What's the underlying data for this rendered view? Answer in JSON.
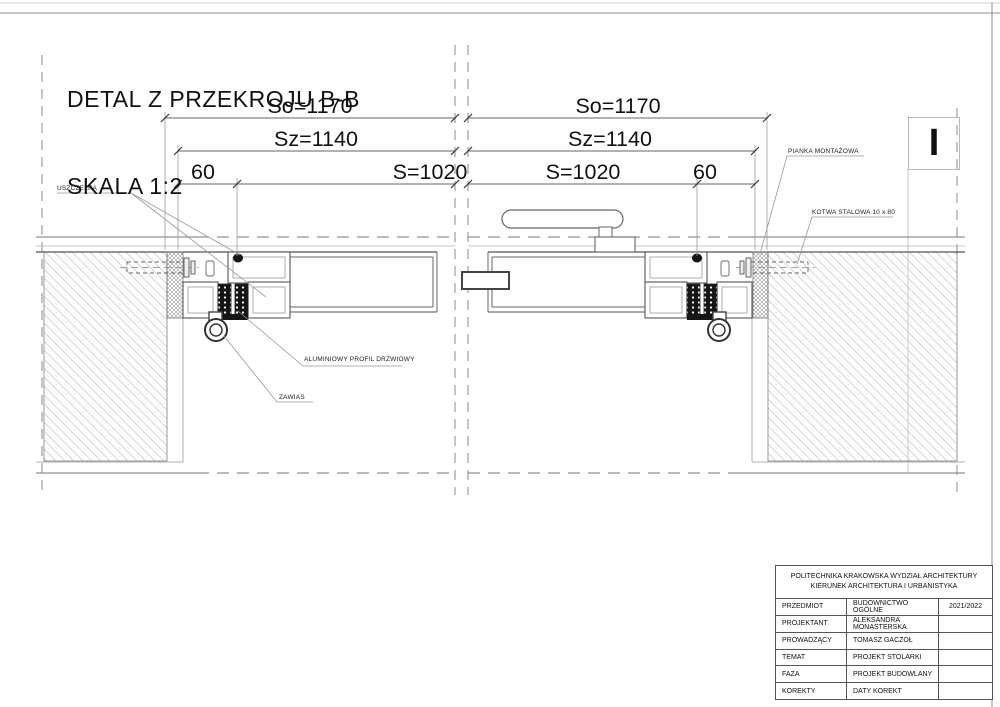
{
  "title": {
    "line1": "DETAL Z PRZEKROJU B-B",
    "line2": "SKALA 1:2"
  },
  "dimensions": {
    "left": {
      "so": "So=1170",
      "sz": "Sz=1140",
      "s": "S=1020",
      "offset": "60"
    },
    "right": {
      "so": "So=1170",
      "sz": "Sz=1140",
      "s": "S=1020",
      "offset": "60"
    }
  },
  "labels": {
    "uszczelka": "USZCZELKA",
    "pianka": "PIANKA MONTAŻOWA",
    "kotwa": "KOTWA STALOWA 10 x 80",
    "profil": "ALUMINIOWY PROFIL DRZWIOWY",
    "zawias": "ZAWIAS"
  },
  "marker": {
    "label": "I"
  },
  "title_block": {
    "header_line1": "POLITECHNIKA KRAKOWSKA WYDZIAŁ ARCHITEKTURY",
    "header_line2": "KIERUNEK ARCHITEKTURA I URBANISTYKA",
    "rows": [
      {
        "label": "PRZEDMIOT",
        "value": "BUDOWNICTWO OGÓLNE",
        "extra": "2021/2022"
      },
      {
        "label": "PROJEKTANT",
        "value": "ALEKSANDRA MONASTERSKA",
        "extra": ""
      },
      {
        "label": "PROWADZĄCY",
        "value": "TOMASZ GACZOŁ",
        "extra": ""
      },
      {
        "label": "TEMAT",
        "value": "PROJEKT STOLARKI",
        "extra": ""
      },
      {
        "label": "FAZA",
        "value": "PROJEKT BUDOWLANY",
        "extra": ""
      },
      {
        "label": "KOREKTY",
        "value": "DATY KOREKT",
        "extra": ""
      }
    ]
  },
  "colors": {
    "line": "#555555",
    "light_line": "#bbbbbb",
    "hatch": "#c9c9c9",
    "thermal": "#151515"
  }
}
